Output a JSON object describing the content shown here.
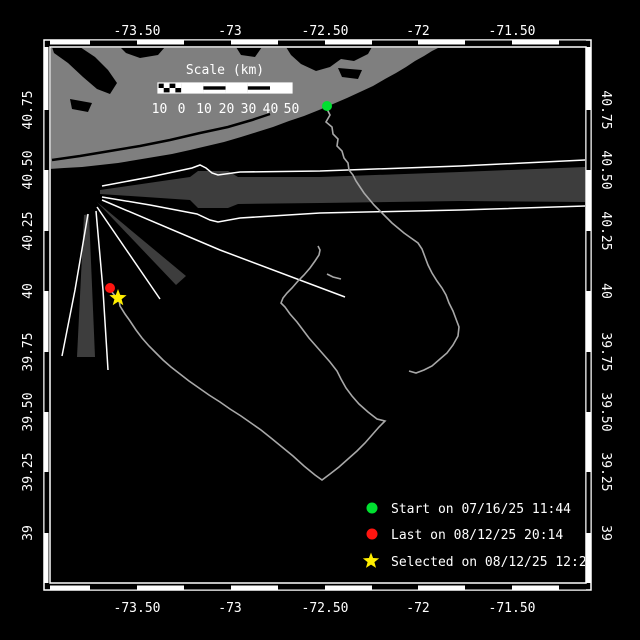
{
  "map": {
    "scale_bar": {
      "title": "Scale (km)",
      "labels": [
        "10",
        "0",
        "10",
        "20",
        "30",
        "40",
        "50"
      ]
    },
    "axes": {
      "lon_labels": [
        "-73.50",
        "-73",
        "-72.50",
        "-72",
        "-71.50"
      ],
      "lat_labels": [
        "40.75",
        "40.50",
        "40.25",
        "40",
        "39.75",
        "39.50",
        "39.25",
        "39"
      ]
    },
    "legend": [
      {
        "marker": "green-dot",
        "color": "#00e030",
        "label": "Start on 07/16/25 11:44"
      },
      {
        "marker": "red-dot",
        "color": "#ff1510",
        "label": "Last on 08/12/25 20:14"
      },
      {
        "marker": "yellow-star",
        "color": "#ffee00",
        "label": "Selected on 08/12/25 12:29"
      }
    ],
    "colors": {
      "background": "#000000",
      "land": "#7f7f7f",
      "shipping_lane": "#3d3d3d",
      "track": "#a8a8a8",
      "frame": "#ffffff",
      "start_marker": "#00e030",
      "last_marker": "#ff1510",
      "selected_marker": "#ffee00"
    }
  }
}
